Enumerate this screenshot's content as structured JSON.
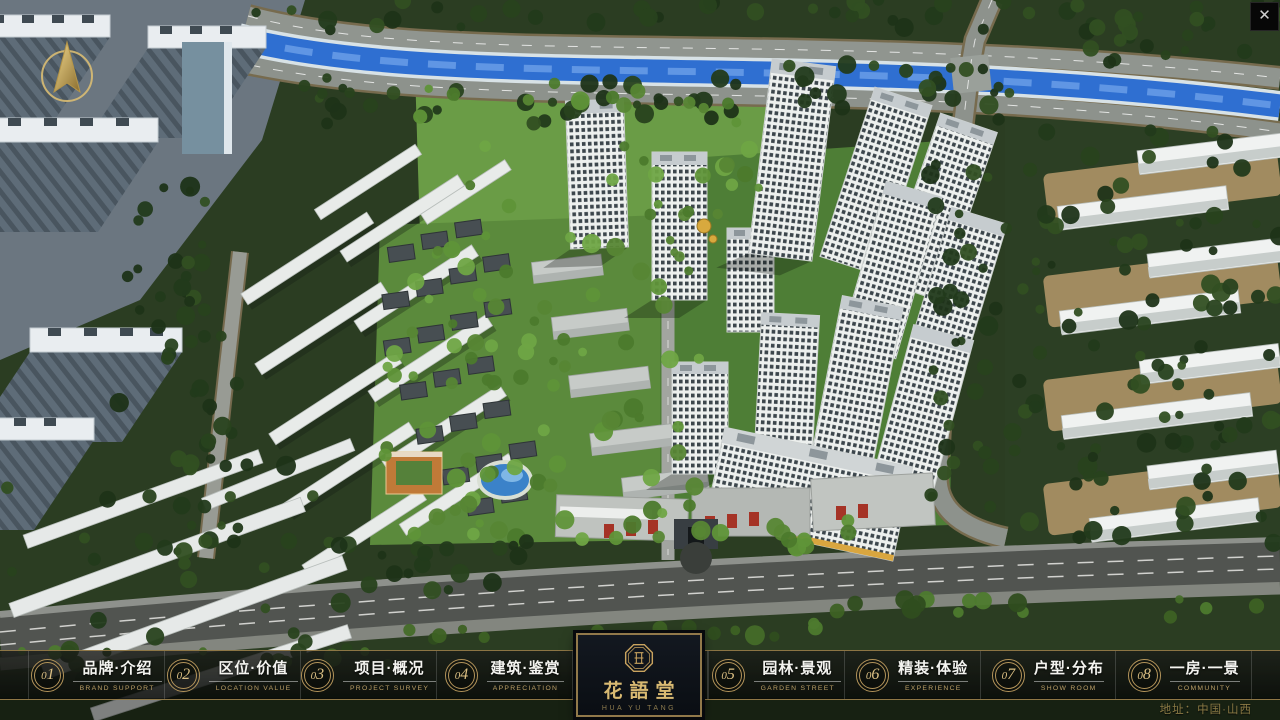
{
  "window": {
    "close_label": "✕"
  },
  "nav": {
    "items": [
      {
        "num": "01",
        "zh": "品牌·介绍",
        "en": "BRAND SUPPORT"
      },
      {
        "num": "02",
        "zh": "区位·价值",
        "en": "LOCATION VALUE"
      },
      {
        "num": "03",
        "zh": "项目·概况",
        "en": "PROJECT SURVEY"
      },
      {
        "num": "04",
        "zh": "建筑·鉴赏",
        "en": "APPRECIATION"
      },
      {
        "num": "05",
        "zh": "园林·景观",
        "en": "GARDEN STREET"
      },
      {
        "num": "06",
        "zh": "精装·体验",
        "en": "EXPERIENCE"
      },
      {
        "num": "07",
        "zh": "户型·分布",
        "en": "SHOW ROOM"
      },
      {
        "num": "08",
        "zh": "一房·一景",
        "en": "COMMUNITY"
      }
    ]
  },
  "logo": {
    "name": "花語堂",
    "caption": "HUA YU TANG"
  },
  "footer": {
    "address": "地址：中国·山西"
  },
  "colors": {
    "gold": "#c9a96a",
    "bar_bg": "rgba(12,14,12,0.8)",
    "river": "#2f6fd1",
    "grass": "#5b8a3c"
  }
}
